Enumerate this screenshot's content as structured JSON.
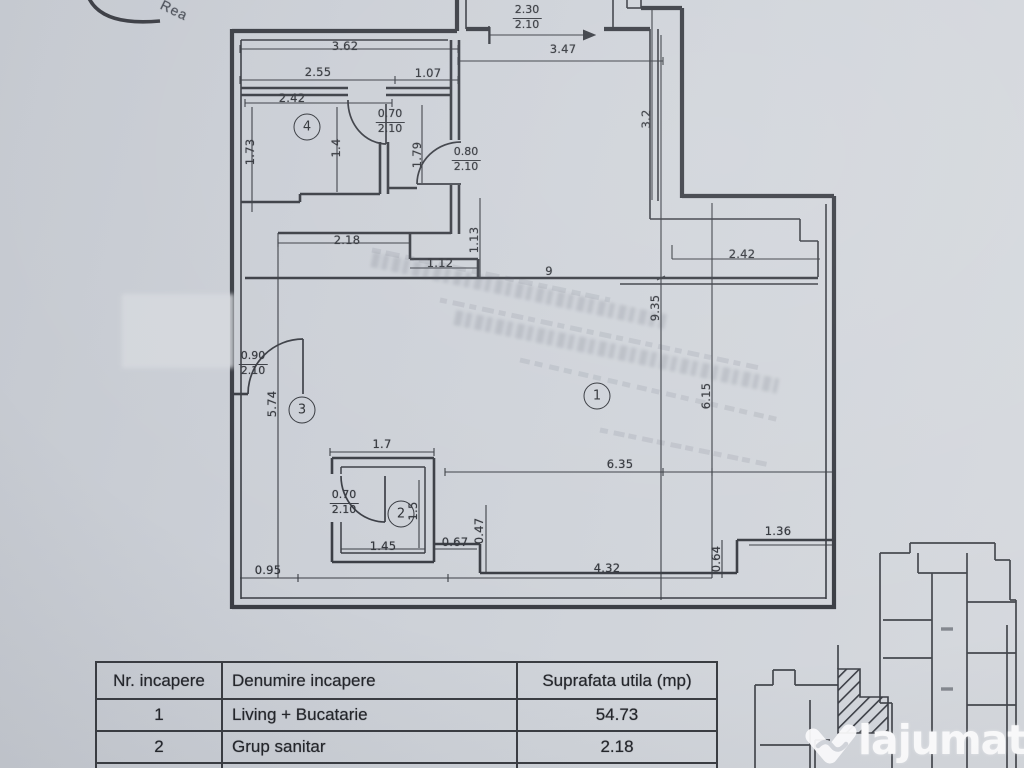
{
  "stamp": {
    "text": "Rea"
  },
  "plan": {
    "room_markers": [
      {
        "n": "1",
        "x": 597,
        "y": 396
      },
      {
        "n": "2",
        "x": 401,
        "y": 514
      },
      {
        "n": "3",
        "x": 302,
        "y": 410
      },
      {
        "n": "4",
        "x": 307,
        "y": 127
      }
    ],
    "dim_labels": [
      {
        "text": "3.62",
        "x": 345,
        "y": 46,
        "rot": 0
      },
      {
        "text": "2.55",
        "x": 318,
        "y": 72,
        "rot": 0
      },
      {
        "text": "1.07",
        "x": 428,
        "y": 73,
        "rot": 0
      },
      {
        "text": "2.42",
        "x": 292,
        "y": 98,
        "rot": 0
      },
      {
        "text": "1.73",
        "x": 250,
        "y": 152,
        "rot": -90
      },
      {
        "text": "1.4",
        "x": 336,
        "y": 148,
        "rot": -90
      },
      {
        "text": "1.79",
        "x": 417,
        "y": 155,
        "rot": -90
      },
      {
        "text": "3.47",
        "x": 563,
        "y": 49,
        "rot": 0
      },
      {
        "text": "3.2",
        "x": 646,
        "y": 119,
        "rot": -90
      },
      {
        "text": "1.13",
        "x": 474,
        "y": 240,
        "rot": -90
      },
      {
        "text": "2.18",
        "x": 347,
        "y": 240,
        "rot": 0
      },
      {
        "text": "1.12",
        "x": 440,
        "y": 263,
        "rot": 0
      },
      {
        "text": "2.42",
        "x": 742,
        "y": 254,
        "rot": 0
      },
      {
        "text": "9",
        "x": 549,
        "y": 271,
        "rot": 0
      },
      {
        "text": "9.35",
        "x": 655,
        "y": 308,
        "rot": -90
      },
      {
        "text": "6.15",
        "x": 706,
        "y": 396,
        "rot": -90
      },
      {
        "text": "5.74",
        "x": 272,
        "y": 404,
        "rot": -90
      },
      {
        "text": "1.7",
        "x": 382,
        "y": 444,
        "rot": 0
      },
      {
        "text": "6.35",
        "x": 620,
        "y": 464,
        "rot": 0
      },
      {
        "text": "1.5",
        "x": 413,
        "y": 511,
        "rot": -90
      },
      {
        "text": "0.47",
        "x": 479,
        "y": 531,
        "rot": -90
      },
      {
        "text": "1.45",
        "x": 383,
        "y": 546,
        "rot": 0
      },
      {
        "text": "0.67",
        "x": 455,
        "y": 542,
        "rot": 0
      },
      {
        "text": "1.36",
        "x": 778,
        "y": 531,
        "rot": 0
      },
      {
        "text": "0.64",
        "x": 716,
        "y": 559,
        "rot": -90
      },
      {
        "text": "4.32",
        "x": 607,
        "y": 568,
        "rot": 0
      },
      {
        "text": "0.95",
        "x": 268,
        "y": 570,
        "rot": 0
      }
    ],
    "door_labels": [
      {
        "top": "2.30",
        "bottom": "2.10",
        "x": 527,
        "y": 4
      },
      {
        "top": "0.70",
        "bottom": "2.10",
        "x": 390,
        "y": 108
      },
      {
        "top": "0.80",
        "bottom": "2.10",
        "x": 466,
        "y": 146
      },
      {
        "top": "0.90",
        "bottom": "2.10",
        "x": 253,
        "y": 350
      },
      {
        "top": "0.70",
        "bottom": "2.10",
        "x": 344,
        "y": 489
      }
    ]
  },
  "table": {
    "headers": [
      "Nr. incapere",
      "Denumire incapere",
      "Suprafata utila (mp)"
    ],
    "rows": [
      {
        "nr": "1",
        "name": "Living + Bucatarie",
        "area": "54.73"
      },
      {
        "nr": "2",
        "name": "Grup sanitar",
        "area": "2.18"
      },
      {
        "nr": "3",
        "name": "Vestibul",
        "area": "5.45"
      }
    ]
  },
  "logo": {
    "brand": "lajumate",
    "tld": ".ro"
  }
}
